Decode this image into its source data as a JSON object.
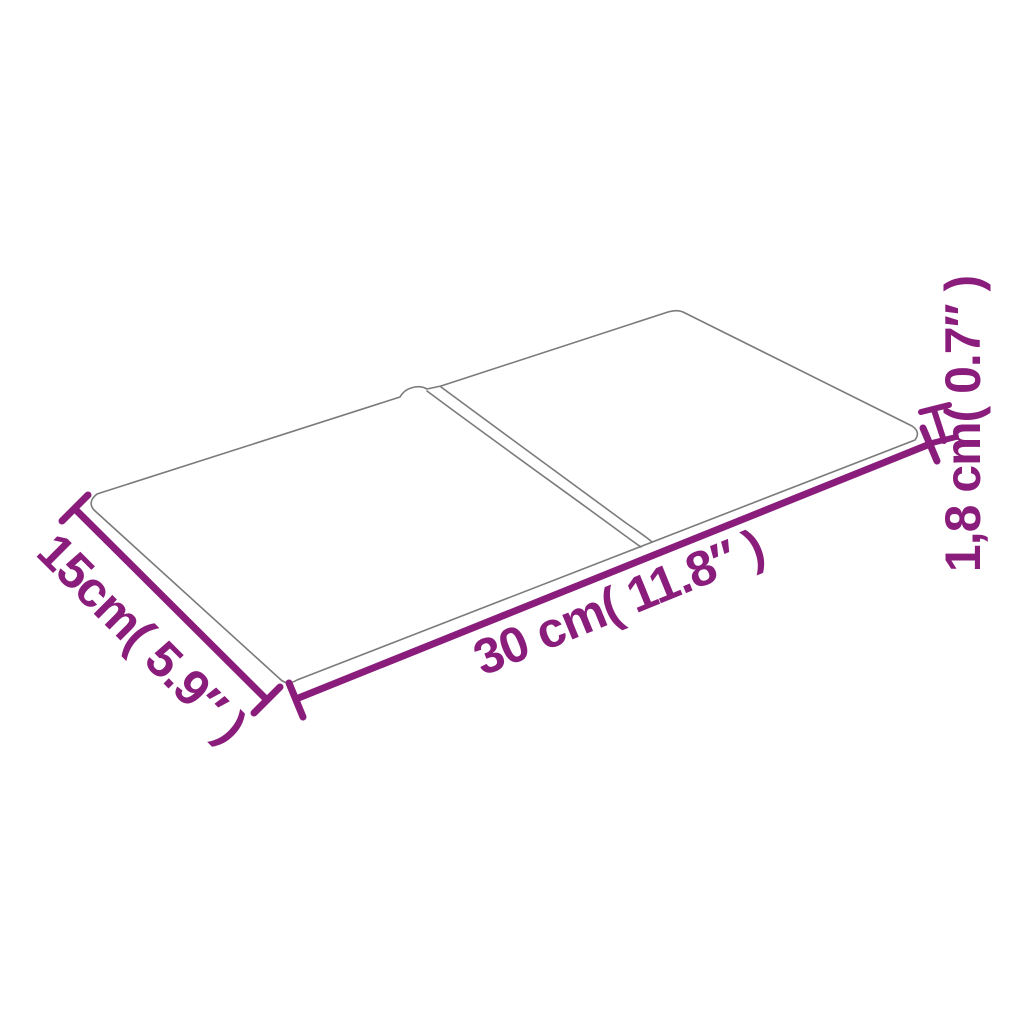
{
  "page": {
    "background_color": "#ffffff",
    "description": "Product dimension diagram of a two-piece rectangular wall panel shown in perspective"
  },
  "diagram": {
    "type": "product-dimension-diagram",
    "panel": {
      "pieces": 2,
      "outline_color": "#7b7b7b",
      "fill_color": "#ffffff"
    },
    "dimensions": {
      "width_label": "30 cm( 11.8″ )",
      "depth_label": "15cm( 5.9″ )",
      "thickness_label": "1,8 cm( 0.7″ )"
    },
    "colors": {
      "dimension": "#8A1C7C",
      "outline": "#7b7b7b"
    }
  }
}
